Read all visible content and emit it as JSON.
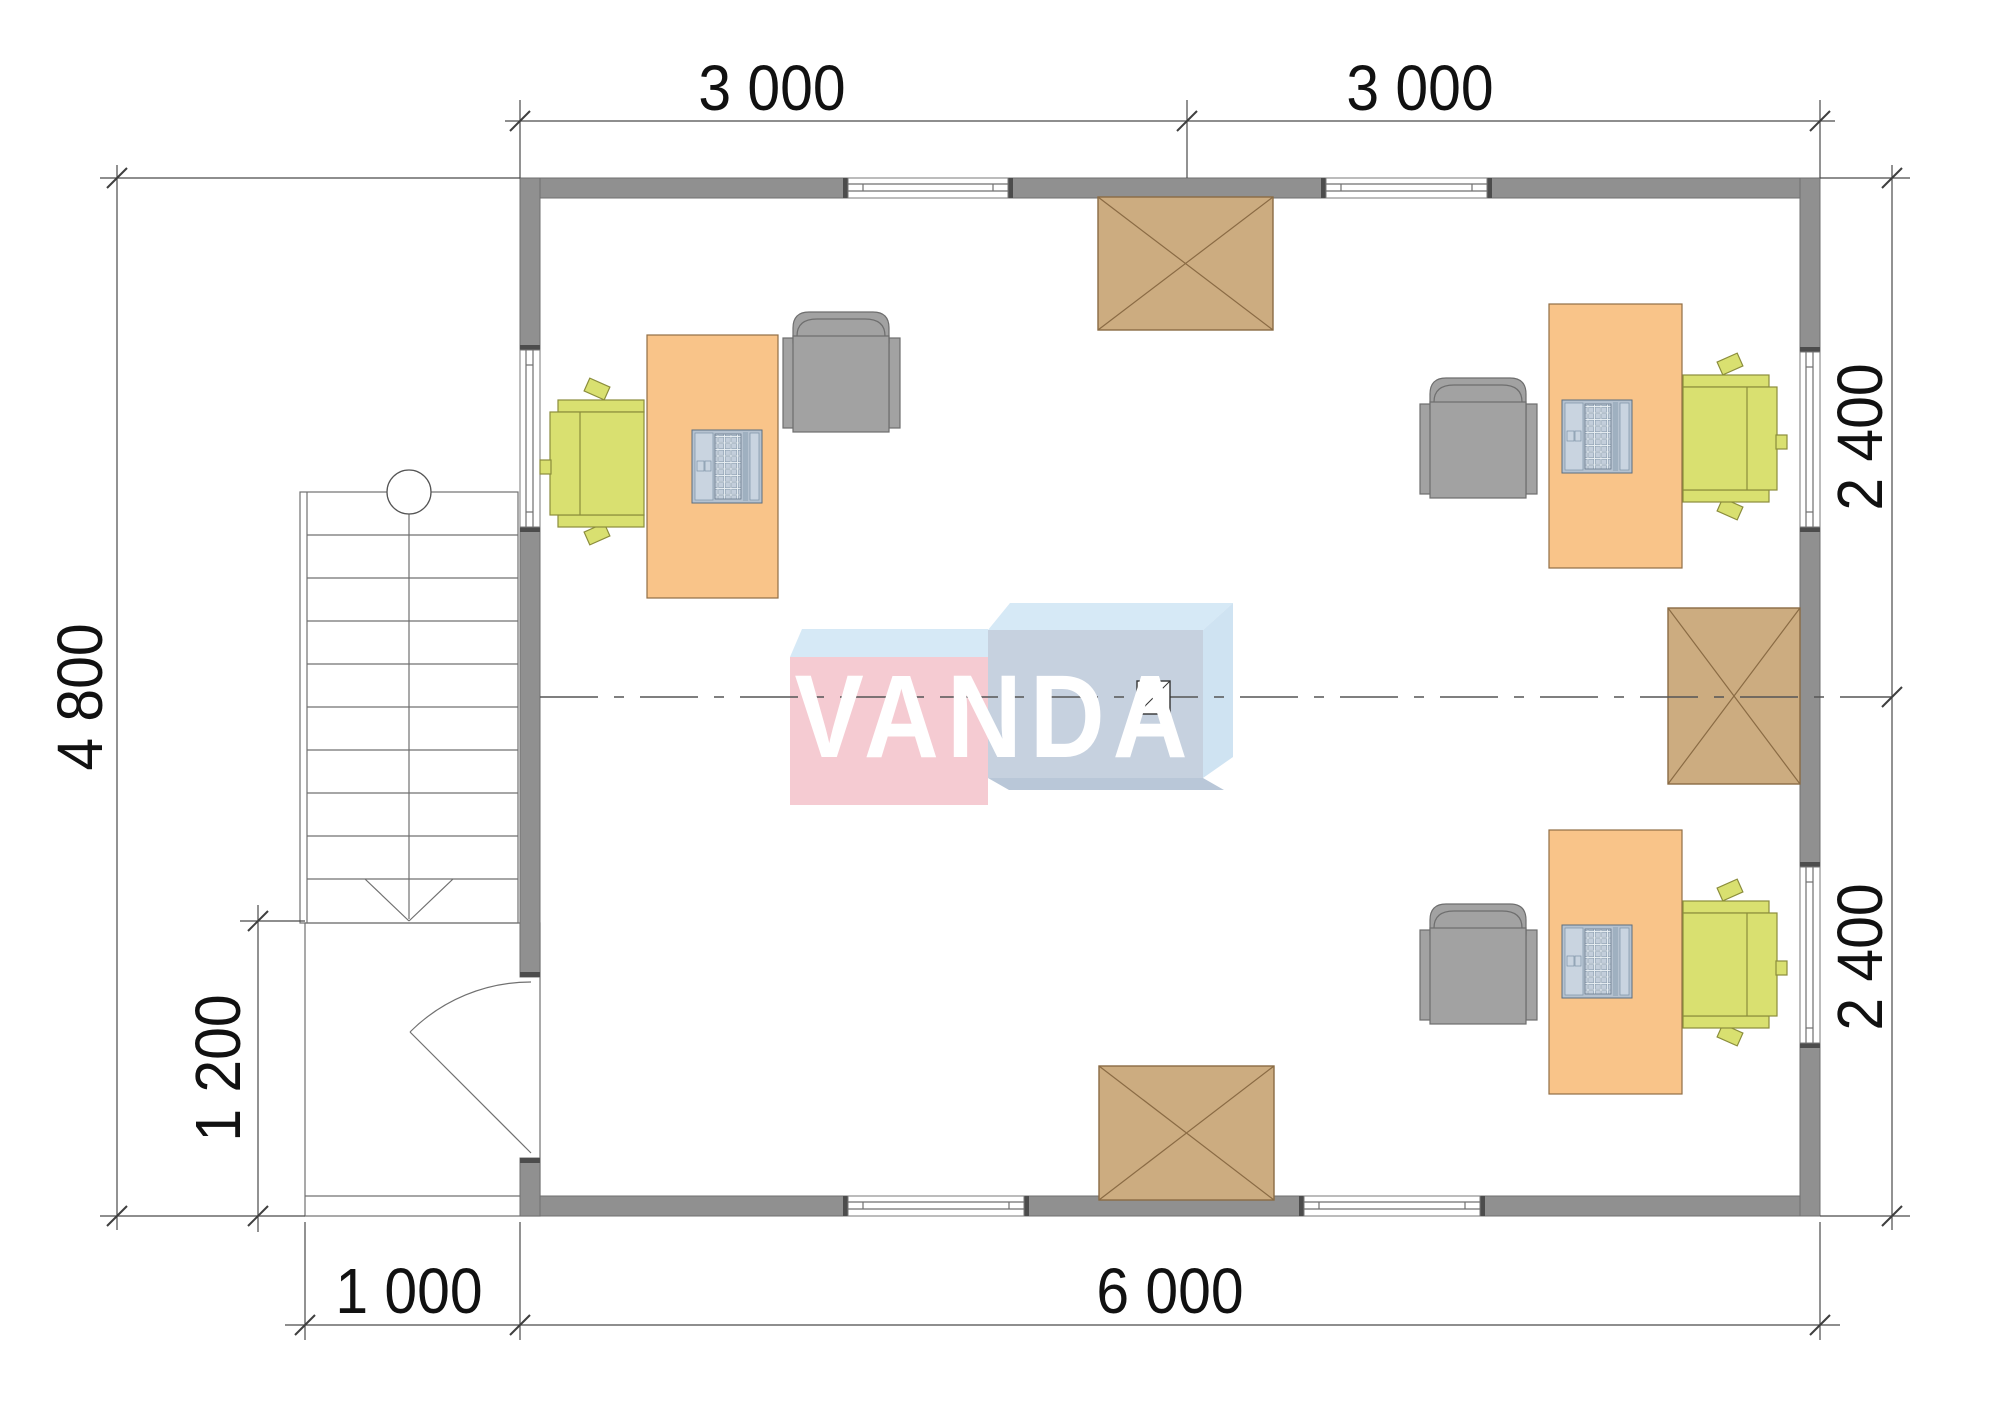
{
  "title": "office-floor-plan",
  "dimensions": {
    "top_left": "3 000",
    "top_right": "3 000",
    "left": "4 800",
    "porch_height": "1 200",
    "right_upper": "2 400",
    "right_lower": "2 400",
    "bottom_porch": "1 000",
    "bottom_main": "6 000"
  },
  "logo": {
    "text": "VANDA"
  },
  "colors": {
    "wall": "#909090",
    "wall_cap": "#4c4c4c",
    "desk": "#f9c489",
    "chair_green": "#d9e070",
    "armchair_gray": "#a2a2a2",
    "table_brown": "#ccac80",
    "logo_pink": "#f5cbd2",
    "logo_blue": "#c6d1df",
    "logo_bevel": "#d6e9f6",
    "logo_bevel_side": "#cfe3f2",
    "logo_shadow": "#b9c7d8",
    "dim_line": "#4a4a4a"
  }
}
